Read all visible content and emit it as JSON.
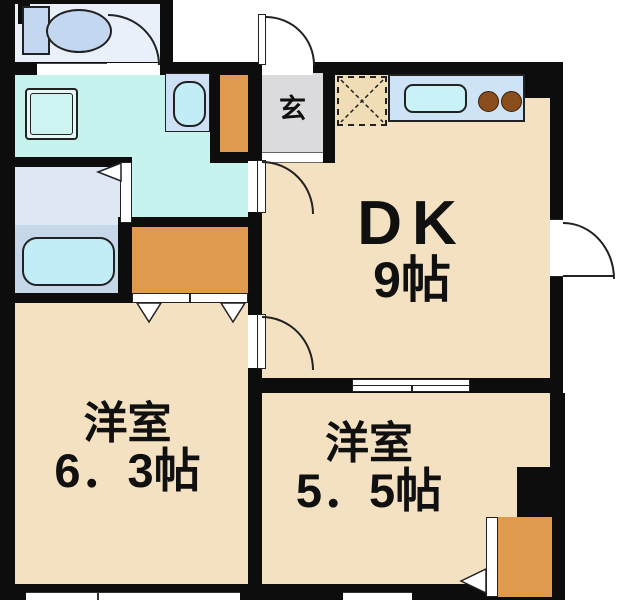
{
  "plan": {
    "entrance": {
      "label": "玄"
    },
    "dk": {
      "name": "DK",
      "size": "9帖"
    },
    "western_room_large": {
      "name": "洋室",
      "size": "6．3帖"
    },
    "western_room_small": {
      "name": "洋室",
      "size": "5．5帖"
    }
  },
  "fixtures": [
    "toilet",
    "vanity-sink",
    "washing-machine-pan",
    "bathtub",
    "kitchen-counter",
    "kitchen-sink",
    "stove-burners",
    "refrigerator-space",
    "shoe-cabinet",
    "hall-closet",
    "corner-closet"
  ],
  "doors": [
    "entrance-door",
    "toilet-door",
    "washroom-door",
    "bathroom-folding-door",
    "bedroom-door",
    "dk-back-door",
    "closet-double-door",
    "closet-door",
    "sliding-window",
    "bottom-windows"
  ],
  "colors": {
    "wall": "#0d0d0d",
    "line": "#222222",
    "room_beige": "#f4e1c1",
    "entrance_gray": "#dbdbde",
    "wet_cyan": "#c7f3ef",
    "bath_upper": "#dde8f4",
    "bath_floor": "#c7d7ea",
    "tub_fill": "#c2ecf6",
    "toilet_room": "#e9f0fa",
    "fixture_blue": "#c3d7f0",
    "counter_blue": "#cfe3f7",
    "sink_cyan": "#c9f2f6",
    "burner_brown": "#8a4e1c",
    "cabinet_orange": "#e09a4e",
    "fridge_bg": "#f0dcb5",
    "vanity_blue": "#cfe0f4"
  }
}
